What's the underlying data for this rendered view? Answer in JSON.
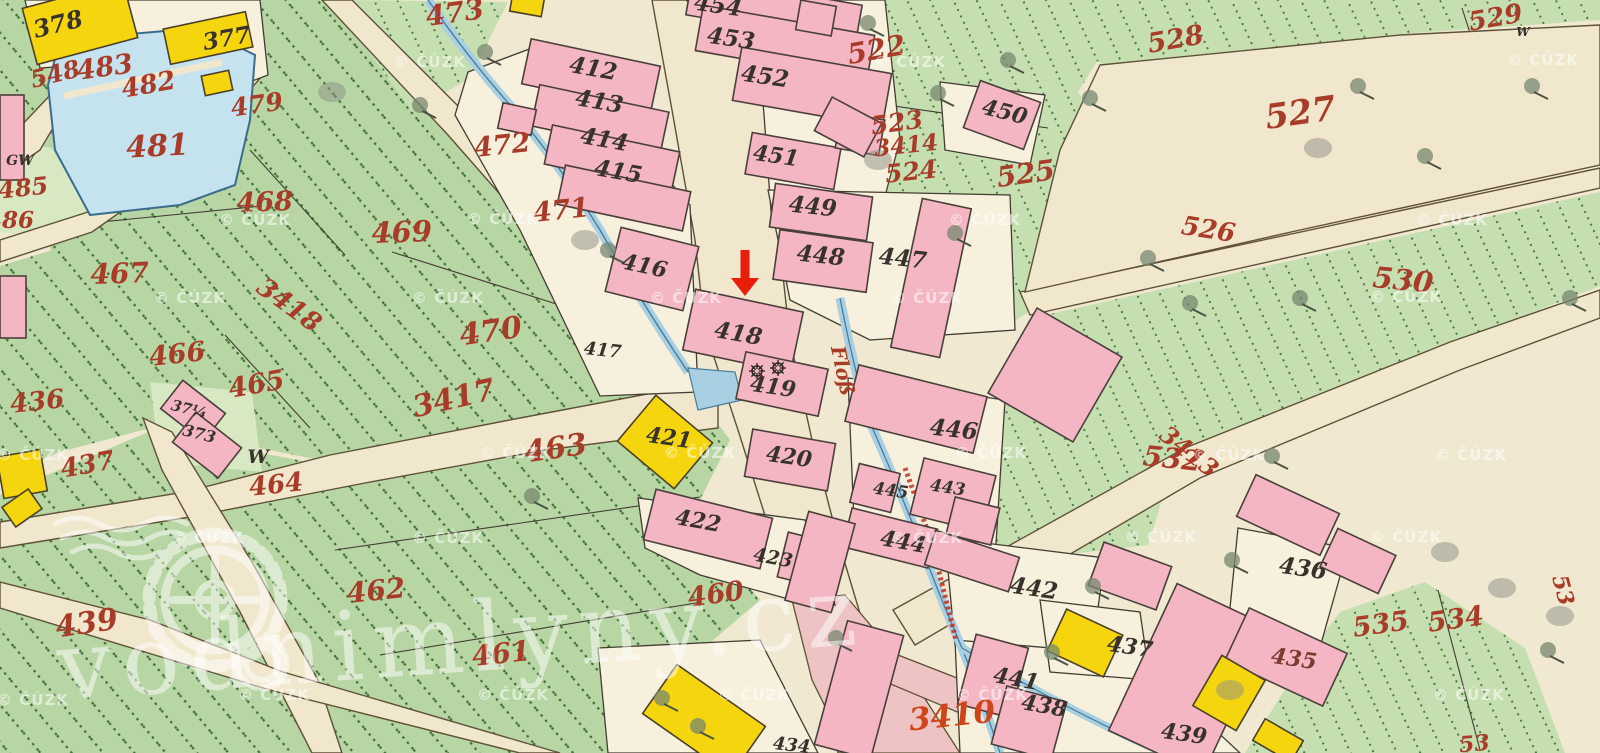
{
  "map": {
    "type": "historical-cadastral-map",
    "colors": {
      "background": "#f0e8d0",
      "green_parcel": "#b7d6a3",
      "green_parcel_light": "#c8e0b2",
      "building_masonry": "#f4b6c3",
      "building_wood": "#f5d60e",
      "water": "#c5e3ef",
      "road": "#f1e7cd",
      "street_pink": "#edc3c3",
      "label_red": "#a93c28",
      "label_black": "#38322c",
      "marker_red": "#ea1d0b"
    },
    "marker": {
      "name": "location-arrow",
      "x": 745,
      "tail_y": 250,
      "tip_y": 296,
      "color": "#ea1d0b"
    },
    "mill_symbols": {
      "name": "watermill-wheel-symbols",
      "positions": [
        [
          757,
          371
        ],
        [
          778,
          368
        ]
      ]
    },
    "labels": [
      {
        "t": "548",
        "x": 57,
        "y": 82,
        "s": 24,
        "r": -14,
        "c": "r"
      },
      {
        "t": "483",
        "x": 106,
        "y": 76,
        "s": 27,
        "r": -8,
        "c": "r"
      },
      {
        "t": "482",
        "x": 150,
        "y": 93,
        "s": 26,
        "r": -10,
        "c": "r"
      },
      {
        "t": "481",
        "x": 158,
        "y": 156,
        "s": 30,
        "r": -3,
        "c": "r"
      },
      {
        "t": "479",
        "x": 258,
        "y": 113,
        "s": 25,
        "r": -8,
        "c": "r"
      },
      {
        "t": "486",
        "x": 10,
        "y": 228,
        "s": 23,
        "r": 0,
        "c": "r"
      },
      {
        "t": "485",
        "x": 24,
        "y": 196,
        "s": 24,
        "r": -6,
        "c": "r"
      },
      {
        "t": "468",
        "x": 265,
        "y": 211,
        "s": 27,
        "r": -2,
        "c": "r"
      },
      {
        "t": "473",
        "x": 456,
        "y": 22,
        "s": 28,
        "r": -8,
        "c": "r"
      },
      {
        "t": "472",
        "x": 503,
        "y": 154,
        "s": 27,
        "r": -6,
        "c": "r"
      },
      {
        "t": "471",
        "x": 562,
        "y": 219,
        "s": 27,
        "r": -6,
        "c": "r"
      },
      {
        "t": "469",
        "x": 402,
        "y": 242,
        "s": 29,
        "r": -2,
        "c": "r"
      },
      {
        "t": "467",
        "x": 120,
        "y": 283,
        "s": 28,
        "r": -2,
        "c": "r"
      },
      {
        "t": "3418",
        "x": 284,
        "y": 312,
        "s": 26,
        "r": 36,
        "c": "r"
      },
      {
        "t": "466",
        "x": 178,
        "y": 363,
        "s": 27,
        "r": -6,
        "c": "r"
      },
      {
        "t": "465",
        "x": 258,
        "y": 393,
        "s": 27,
        "r": -10,
        "c": "r"
      },
      {
        "t": "436",
        "x": 38,
        "y": 410,
        "s": 26,
        "r": -6,
        "c": "r"
      },
      {
        "t": "437",
        "x": 89,
        "y": 473,
        "s": 26,
        "r": -10,
        "c": "r"
      },
      {
        "t": "470",
        "x": 492,
        "y": 341,
        "s": 30,
        "r": -8,
        "c": "r"
      },
      {
        "t": "3417",
        "x": 456,
        "y": 408,
        "s": 30,
        "r": -13,
        "c": "r"
      },
      {
        "t": "463",
        "x": 557,
        "y": 458,
        "s": 30,
        "r": -8,
        "c": "r"
      },
      {
        "t": "464",
        "x": 277,
        "y": 493,
        "s": 26,
        "r": -6,
        "c": "r"
      },
      {
        "t": "462",
        "x": 377,
        "y": 600,
        "s": 28,
        "r": -6,
        "c": "r"
      },
      {
        "t": "461",
        "x": 502,
        "y": 663,
        "s": 28,
        "r": -6,
        "c": "r"
      },
      {
        "t": "460",
        "x": 717,
        "y": 603,
        "s": 27,
        "r": -8,
        "c": "r"
      },
      {
        "t": "439",
        "x": 88,
        "y": 633,
        "s": 30,
        "r": -8,
        "c": "r"
      },
      {
        "t": "522",
        "x": 878,
        "y": 59,
        "s": 28,
        "r": -10,
        "c": "r"
      },
      {
        "t": "523",
        "x": 898,
        "y": 131,
        "s": 25,
        "r": -8,
        "c": "r"
      },
      {
        "t": "3414",
        "x": 907,
        "y": 153,
        "s": 23,
        "r": -6,
        "c": "r"
      },
      {
        "t": "524",
        "x": 912,
        "y": 180,
        "s": 25,
        "r": -6,
        "c": "r"
      },
      {
        "t": "525",
        "x": 1027,
        "y": 183,
        "s": 28,
        "r": -8,
        "c": "r"
      },
      {
        "t": "526",
        "x": 1207,
        "y": 238,
        "s": 26,
        "r": 9,
        "c": "r"
      },
      {
        "t": "527",
        "x": 1302,
        "y": 124,
        "s": 34,
        "r": -8,
        "c": "r"
      },
      {
        "t": "528",
        "x": 1177,
        "y": 48,
        "s": 27,
        "r": -10,
        "c": "r"
      },
      {
        "t": "529",
        "x": 1497,
        "y": 26,
        "s": 26,
        "r": -10,
        "c": "r"
      },
      {
        "t": "530",
        "x": 1402,
        "y": 290,
        "s": 29,
        "r": 6,
        "c": "r"
      },
      {
        "t": "532",
        "x": 1171,
        "y": 468,
        "s": 28,
        "r": 6,
        "c": "r"
      },
      {
        "t": "3413",
        "x": 1184,
        "y": 458,
        "s": 24,
        "r": 38,
        "c": "r"
      },
      {
        "t": "535",
        "x": 1382,
        "y": 633,
        "s": 27,
        "r": -8,
        "c": "r"
      },
      {
        "t": "534",
        "x": 1457,
        "y": 628,
        "s": 27,
        "r": -8,
        "c": "r"
      },
      {
        "t": "53",
        "x": 1556,
        "y": 592,
        "s": 22,
        "r": 75,
        "c": "r"
      },
      {
        "t": "53",
        "x": 1475,
        "y": 751,
        "s": 22,
        "r": -5,
        "c": "r"
      },
      {
        "t": "Floß",
        "x": 836,
        "y": 372,
        "s": 20,
        "r": 78,
        "c": "r"
      },
      {
        "t": "3410",
        "x": 953,
        "y": 726,
        "s": 31,
        "r": -6,
        "c": "o"
      },
      {
        "t": "378",
        "x": 60,
        "y": 32,
        "s": 24,
        "r": -14,
        "c": "k"
      },
      {
        "t": "377",
        "x": 228,
        "y": 46,
        "s": 23,
        "r": -10,
        "c": "k"
      },
      {
        "t": "412",
        "x": 592,
        "y": 76,
        "s": 23,
        "r": 10,
        "c": "k"
      },
      {
        "t": "413",
        "x": 598,
        "y": 109,
        "s": 23,
        "r": 10,
        "c": "k"
      },
      {
        "t": "414",
        "x": 603,
        "y": 147,
        "s": 23,
        "r": 10,
        "c": "k"
      },
      {
        "t": "415",
        "x": 617,
        "y": 179,
        "s": 23,
        "r": 10,
        "c": "k"
      },
      {
        "t": "454",
        "x": 717,
        "y": 13,
        "s": 23,
        "r": 8,
        "c": "k"
      },
      {
        "t": "453",
        "x": 730,
        "y": 46,
        "s": 23,
        "r": 8,
        "c": "k"
      },
      {
        "t": "452",
        "x": 764,
        "y": 84,
        "s": 23,
        "r": 8,
        "c": "k"
      },
      {
        "t": "451",
        "x": 775,
        "y": 163,
        "s": 22,
        "r": 8,
        "c": "k"
      },
      {
        "t": "450",
        "x": 1003,
        "y": 119,
        "s": 22,
        "r": 14,
        "c": "k"
      },
      {
        "t": "449",
        "x": 812,
        "y": 214,
        "s": 23,
        "r": 6,
        "c": "k"
      },
      {
        "t": "448",
        "x": 820,
        "y": 263,
        "s": 23,
        "r": 6,
        "c": "k"
      },
      {
        "t": "447",
        "x": 902,
        "y": 266,
        "s": 23,
        "r": 6,
        "c": "k"
      },
      {
        "t": "446",
        "x": 953,
        "y": 437,
        "s": 23,
        "r": 6,
        "c": "k"
      },
      {
        "t": "416",
        "x": 643,
        "y": 273,
        "s": 22,
        "r": 12,
        "c": "k"
      },
      {
        "t": "417",
        "x": 602,
        "y": 356,
        "s": 18,
        "r": 6,
        "c": "k"
      },
      {
        "t": "418",
        "x": 737,
        "y": 341,
        "s": 23,
        "r": 10,
        "c": "k"
      },
      {
        "t": "419",
        "x": 772,
        "y": 394,
        "s": 22,
        "r": 8,
        "c": "k"
      },
      {
        "t": "421",
        "x": 668,
        "y": 445,
        "s": 22,
        "r": 8,
        "c": "k"
      },
      {
        "t": "420",
        "x": 788,
        "y": 464,
        "s": 22,
        "r": 8,
        "c": "k"
      },
      {
        "t": "422",
        "x": 697,
        "y": 528,
        "s": 22,
        "r": 10,
        "c": "k"
      },
      {
        "t": "423",
        "x": 772,
        "y": 564,
        "s": 19,
        "r": 10,
        "c": "k"
      },
      {
        "t": "445",
        "x": 890,
        "y": 496,
        "s": 17,
        "r": 8,
        "c": "k"
      },
      {
        "t": "443",
        "x": 947,
        "y": 493,
        "s": 17,
        "r": 8,
        "c": "k"
      },
      {
        "t": "444",
        "x": 902,
        "y": 549,
        "s": 22,
        "r": 10,
        "c": "k"
      },
      {
        "t": "442",
        "x": 1033,
        "y": 596,
        "s": 23,
        "r": 8,
        "c": "k"
      },
      {
        "t": "437",
        "x": 1129,
        "y": 654,
        "s": 22,
        "r": 8,
        "c": "k"
      },
      {
        "t": "441",
        "x": 1015,
        "y": 686,
        "s": 22,
        "r": 10,
        "c": "k"
      },
      {
        "t": "438",
        "x": 1043,
        "y": 713,
        "s": 22,
        "r": 10,
        "c": "k"
      },
      {
        "t": "439",
        "x": 1183,
        "y": 741,
        "s": 22,
        "r": 8,
        "c": "k"
      },
      {
        "t": "436",
        "x": 1302,
        "y": 576,
        "s": 23,
        "r": 8,
        "c": "k"
      },
      {
        "t": "434",
        "x": 791,
        "y": 751,
        "s": 18,
        "r": 6,
        "c": "k"
      },
      {
        "t": "37¼",
        "x": 188,
        "y": 414,
        "s": 15,
        "r": 14,
        "c": "k"
      },
      {
        "t": "373",
        "x": 198,
        "y": 439,
        "s": 16,
        "r": 14,
        "c": "k"
      },
      {
        "t": "W",
        "x": 258,
        "y": 463,
        "s": 19,
        "r": 0,
        "c": "k"
      },
      {
        "t": "GW",
        "x": 20,
        "y": 165,
        "s": 14,
        "r": 0,
        "c": "k"
      },
      {
        "t": "W",
        "x": 1523,
        "y": 36,
        "s": 12,
        "r": 0,
        "c": "k"
      },
      {
        "t": "435",
        "x": 1293,
        "y": 666,
        "s": 22,
        "r": 8,
        "c": "m"
      }
    ],
    "buildings_pink": [
      [
        525,
        52,
        132,
        46,
        12
      ],
      [
        534,
        98,
        132,
        42,
        12
      ],
      [
        547,
        138,
        130,
        40,
        12
      ],
      [
        560,
        178,
        128,
        40,
        12
      ],
      [
        500,
        106,
        34,
        26,
        12
      ],
      [
        612,
        236,
        80,
        66,
        14
      ],
      [
        688,
        300,
        110,
        62,
        12
      ],
      [
        740,
        360,
        84,
        48,
        12
      ],
      [
        748,
        436,
        84,
        48,
        10
      ],
      [
        648,
        503,
        120,
        52,
        14
      ],
      [
        782,
        538,
        54,
        46,
        14
      ],
      [
        688,
        -10,
        172,
        40,
        10
      ],
      [
        698,
        20,
        174,
        46,
        10
      ],
      [
        736,
        60,
        152,
        54,
        10
      ],
      [
        748,
        140,
        90,
        42,
        10
      ],
      [
        838,
        116,
        44,
        36,
        10
      ],
      [
        820,
        108,
        56,
        38,
        28
      ],
      [
        970,
        90,
        64,
        50,
        20
      ],
      [
        772,
        190,
        98,
        44,
        8
      ],
      [
        776,
        236,
        94,
        50,
        8
      ],
      [
        906,
        202,
        50,
        152,
        12
      ],
      [
        1006,
        326,
        98,
        98,
        30
      ],
      [
        850,
        380,
        132,
        58,
        14
      ],
      [
        916,
        466,
        74,
        58,
        14
      ],
      [
        854,
        468,
        42,
        40,
        14
      ],
      [
        846,
        518,
        88,
        40,
        14
      ],
      [
        950,
        502,
        46,
        38,
        14
      ],
      [
        928,
        543,
        88,
        36,
        18
      ],
      [
        1094,
        553,
        72,
        46,
        20
      ],
      [
        966,
        640,
        54,
        72,
        15
      ],
      [
        998,
        693,
        62,
        60,
        15
      ],
      [
        796,
        516,
        48,
        92,
        15
      ],
      [
        830,
        626,
        58,
        128,
        15
      ],
      [
        1242,
        492,
        92,
        46,
        25
      ],
      [
        1326,
        540,
        64,
        42,
        25
      ],
      [
        1138,
        598,
        104,
        162,
        25
      ],
      [
        1232,
        628,
        108,
        58,
        25
      ],
      [
        166,
        393,
        54,
        36,
        38
      ],
      [
        178,
        426,
        58,
        38,
        38
      ],
      [
        0,
        95,
        24,
        85,
        0
      ],
      [
        0,
        276,
        26,
        62,
        0
      ],
      [
        798,
        3,
        36,
        30,
        10
      ]
    ],
    "buildings_yellow": [
      [
        28,
        -6,
        104,
        58,
        -15
      ],
      [
        166,
        20,
        84,
        36,
        -12
      ],
      [
        203,
        73,
        28,
        20,
        -12
      ],
      [
        511,
        -4,
        32,
        18,
        10
      ],
      [
        628,
        412,
        74,
        60,
        40
      ],
      [
        0,
        453,
        44,
        42,
        -10
      ],
      [
        6,
        496,
        32,
        24,
        -35
      ],
      [
        650,
        690,
        108,
        60,
        35
      ],
      [
        1054,
        620,
        62,
        46,
        25
      ],
      [
        1204,
        664,
        50,
        58,
        30
      ],
      [
        1256,
        728,
        44,
        25,
        30
      ]
    ],
    "trees": [
      [
        485,
        52
      ],
      [
        1008,
        60
      ],
      [
        955,
        233
      ],
      [
        1090,
        98
      ],
      [
        1190,
        303
      ],
      [
        1300,
        298
      ],
      [
        1358,
        86
      ],
      [
        532,
        496
      ],
      [
        698,
        726
      ],
      [
        836,
        638
      ],
      [
        1272,
        456
      ],
      [
        1532,
        86
      ],
      [
        1570,
        298
      ],
      [
        1052,
        652
      ],
      [
        1093,
        586
      ],
      [
        1232,
        560
      ],
      [
        1425,
        156
      ],
      [
        1548,
        650
      ],
      [
        608,
        250
      ],
      [
        868,
        23
      ],
      [
        938,
        93
      ],
      [
        1148,
        258
      ],
      [
        662,
        698
      ],
      [
        420,
        105
      ]
    ],
    "shadow_blobs": [
      [
        332,
        92
      ],
      [
        1318,
        148
      ],
      [
        1445,
        552
      ],
      [
        1502,
        588
      ],
      [
        1560,
        616
      ],
      [
        878,
        160
      ],
      [
        585,
        240
      ],
      [
        1230,
        690
      ]
    ]
  },
  "watermarks": {
    "copyright": "© ČÚZK",
    "positions": [
      [
        430,
        67
      ],
      [
        910,
        67
      ],
      [
        1543,
        65
      ],
      [
        255,
        225
      ],
      [
        503,
        224
      ],
      [
        985,
        225
      ],
      [
        1452,
        225
      ],
      [
        190,
        303
      ],
      [
        448,
        303
      ],
      [
        686,
        303
      ],
      [
        927,
        303
      ],
      [
        1406,
        302
      ],
      [
        33,
        460
      ],
      [
        516,
        458
      ],
      [
        700,
        458
      ],
      [
        991,
        458
      ],
      [
        1229,
        460
      ],
      [
        1471,
        460
      ],
      [
        208,
        543
      ],
      [
        448,
        543
      ],
      [
        927,
        543
      ],
      [
        1161,
        542
      ],
      [
        1406,
        542
      ],
      [
        33,
        705
      ],
      [
        274,
        700
      ],
      [
        513,
        700
      ],
      [
        754,
        700
      ],
      [
        992,
        700
      ],
      [
        1469,
        700
      ]
    ],
    "brand": "vodnimlyny.cz"
  }
}
